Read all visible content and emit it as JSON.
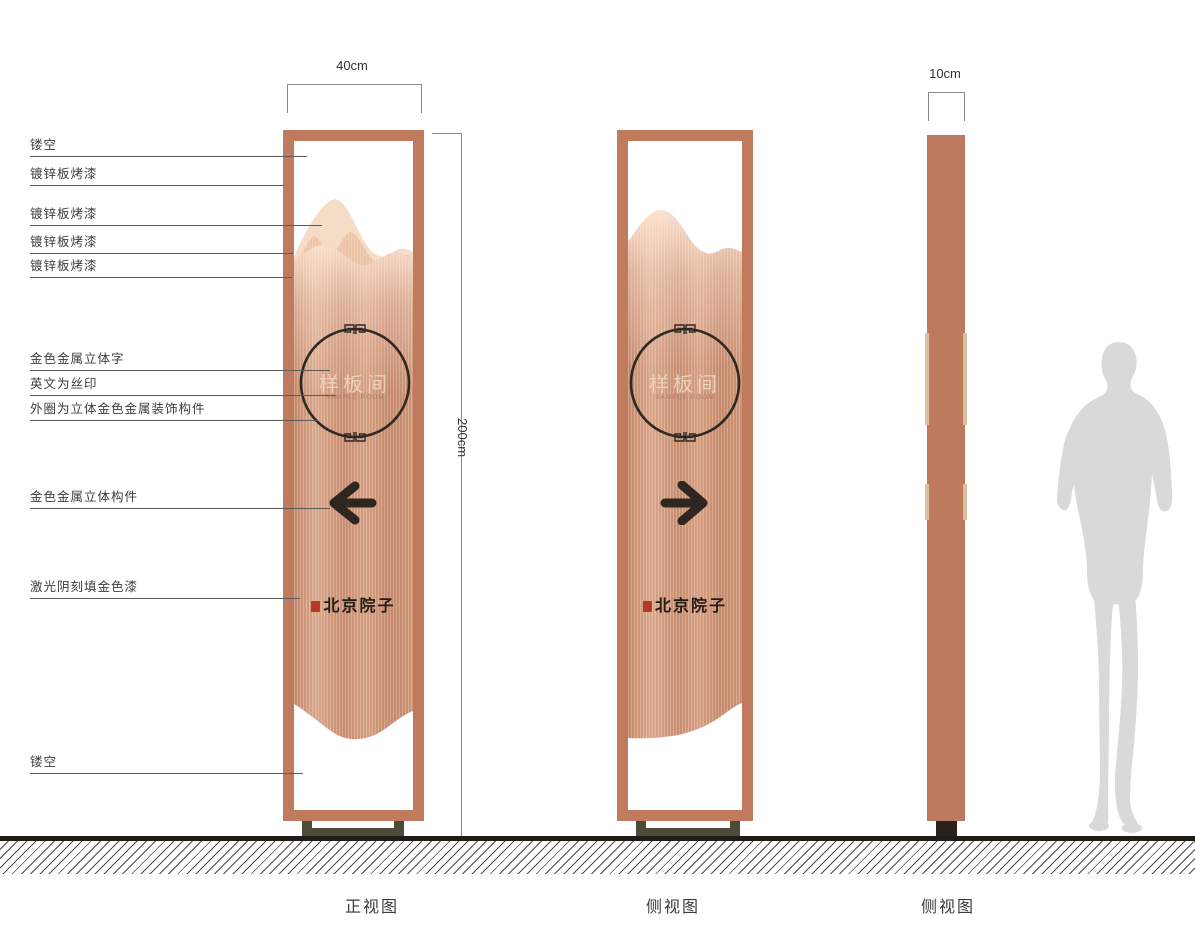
{
  "callouts": [
    "镂空",
    "镀锌板烤漆",
    "镀锌板烤漆",
    "镀锌板烤漆",
    "镀锌板烤漆",
    "金色金属立体字",
    "英文为丝印",
    "外圈为立体金色金属装饰构件",
    "金色金属立体构件",
    "激光阴刻填金色漆",
    "镂空"
  ],
  "dimensions": {
    "front_width": "40cm",
    "height": "200cm",
    "side_width": "10cm"
  },
  "views": {
    "front": "正视图",
    "side": "侧视图",
    "side2": "侧视图"
  },
  "sign": {
    "room_name": "样板间",
    "room_name_en": "SAMPLE ROOM",
    "brand": "北京院子",
    "arrow_front": "left",
    "arrow_side": "right"
  },
  "colors": {
    "frame_copper": "#c07a5d",
    "panel_copper": "#cf9678",
    "mountain_light": "#f4dcc6",
    "mountain_mid": "#eec7ab",
    "ink": "#2f2823",
    "seal_red": "#b5382a",
    "base_olive": "#4e4b3a",
    "side_base_dark": "#2a211b",
    "silhouette_grey": "#d9d9d9"
  }
}
